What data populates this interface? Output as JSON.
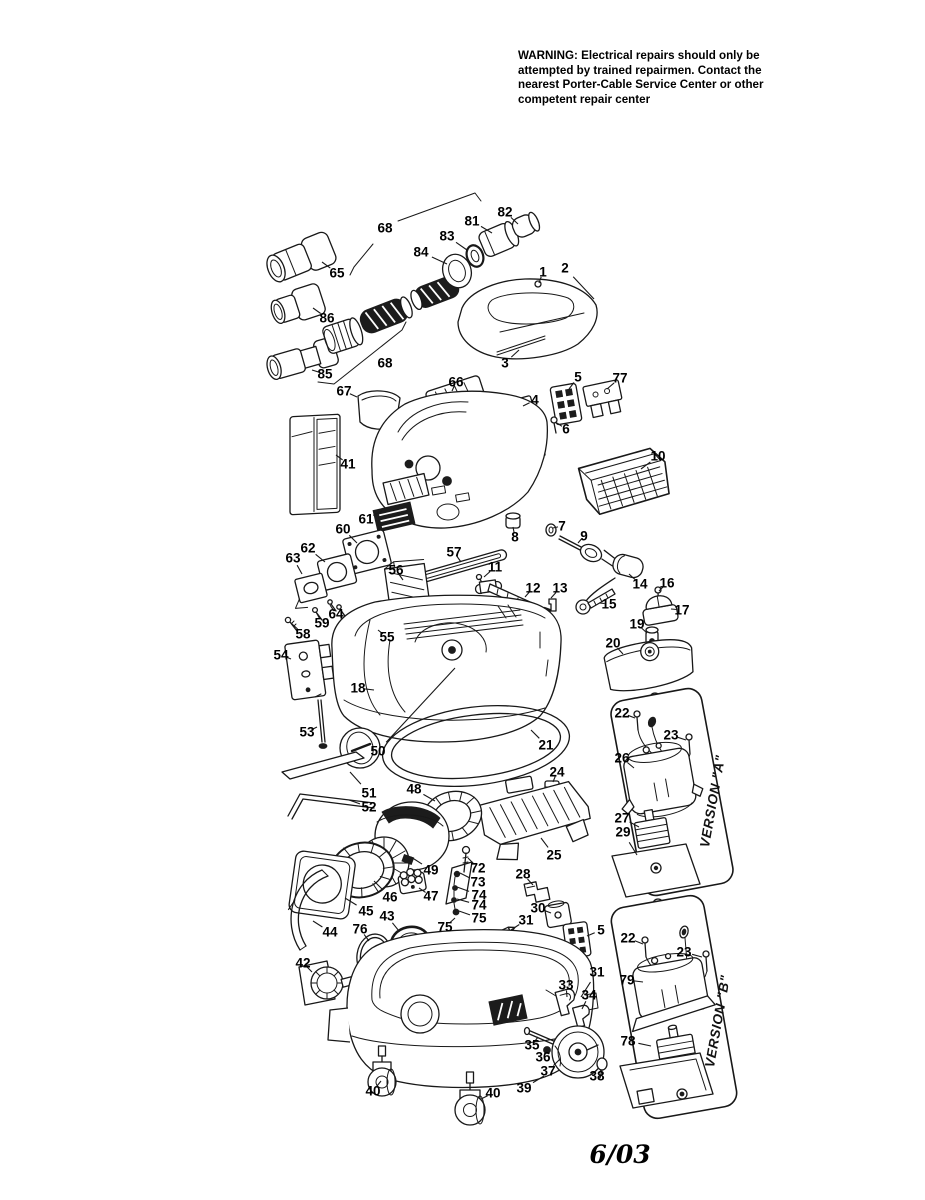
{
  "warning": {
    "lines": [
      "WARNING: Electrical repairs should only be",
      "attempted by trained repairmen. Contact the",
      "nearest Porter-Cable Service Center or other",
      "competent  repair center"
    ]
  },
  "footer": {
    "revision_date": "6/03"
  },
  "diagram": {
    "version_a_label": "VERSION \"A\"",
    "version_b_label": "VERSION \"B\"",
    "labels": [
      {
        "t": "68",
        "x": 385,
        "y": 228
      },
      {
        "t": "82",
        "x": 505,
        "y": 212,
        "lx": 518,
        "ly": 224
      },
      {
        "t": "81",
        "x": 472,
        "y": 221,
        "lx": 492,
        "ly": 233
      },
      {
        "t": "83",
        "x": 447,
        "y": 236,
        "lx": 467,
        "ly": 250
      },
      {
        "t": "84",
        "x": 421,
        "y": 252,
        "lx": 447,
        "ly": 264
      },
      {
        "t": "65",
        "x": 337,
        "y": 273,
        "lx": 322,
        "ly": 262
      },
      {
        "t": "1",
        "x": 543,
        "y": 272,
        "lx": 539,
        "ly": 283
      },
      {
        "t": "2",
        "x": 565,
        "y": 268,
        "lx": 594,
        "ly": 299
      },
      {
        "t": "86",
        "x": 327,
        "y": 318,
        "lx": 313,
        "ly": 308
      },
      {
        "t": "85",
        "x": 325,
        "y": 374,
        "lx": 312,
        "ly": 370
      },
      {
        "t": "68",
        "x": 385,
        "y": 363
      },
      {
        "t": "3",
        "x": 505,
        "y": 363,
        "lx": 519,
        "ly": 350
      },
      {
        "t": "67",
        "x": 344,
        "y": 391,
        "lx": 357,
        "ly": 397
      },
      {
        "t": "66",
        "x": 456,
        "y": 382,
        "lx": 452,
        "ly": 391
      },
      {
        "t": "5",
        "x": 578,
        "y": 377,
        "lx": 569,
        "ly": 389
      },
      {
        "t": "77",
        "x": 620,
        "y": 378,
        "lx": 607,
        "ly": 389
      },
      {
        "t": "4",
        "x": 535,
        "y": 400,
        "lx": 523,
        "ly": 406
      },
      {
        "t": "6",
        "x": 566,
        "y": 429,
        "lx": 557,
        "ly": 423
      },
      {
        "t": "41",
        "x": 348,
        "y": 464,
        "lx": 336,
        "ly": 455
      },
      {
        "t": "10",
        "x": 658,
        "y": 456,
        "lx": 641,
        "ly": 469
      },
      {
        "t": "61",
        "x": 366,
        "y": 519,
        "lx": 382,
        "ly": 511
      },
      {
        "t": "60",
        "x": 343,
        "y": 529,
        "lx": 357,
        "ly": 543
      },
      {
        "t": "62",
        "x": 308,
        "y": 548,
        "lx": 325,
        "ly": 562
      },
      {
        "t": "63",
        "x": 293,
        "y": 558,
        "lx": 302,
        "ly": 574
      },
      {
        "t": "8",
        "x": 515,
        "y": 537,
        "lx": 513,
        "ly": 527
      },
      {
        "t": "7",
        "x": 562,
        "y": 526,
        "lx": 553,
        "ly": 528
      },
      {
        "t": "9",
        "x": 584,
        "y": 536,
        "lx": 578,
        "ly": 543
      },
      {
        "t": "57",
        "x": 454,
        "y": 552,
        "lx": 461,
        "ly": 562
      },
      {
        "t": "56",
        "x": 396,
        "y": 570,
        "lx": 403,
        "ly": 580
      },
      {
        "t": "11",
        "x": 495,
        "y": 567,
        "lx": 484,
        "ly": 577
      },
      {
        "t": "12",
        "x": 533,
        "y": 588,
        "lx": 525,
        "ly": 597
      },
      {
        "t": "13",
        "x": 560,
        "y": 588,
        "lx": 551,
        "ly": 598
      },
      {
        "t": "14",
        "x": 640,
        "y": 584,
        "lx": 629,
        "ly": 574
      },
      {
        "t": "16",
        "x": 667,
        "y": 583,
        "lx": 659,
        "ly": 591
      },
      {
        "t": "15",
        "x": 609,
        "y": 604,
        "lx": 599,
        "ly": 603
      },
      {
        "t": "17",
        "x": 682,
        "y": 610,
        "lx": 671,
        "ly": 609
      },
      {
        "t": "64",
        "x": 336,
        "y": 614,
        "lx": 330,
        "ly": 605
      },
      {
        "t": "59",
        "x": 322,
        "y": 623,
        "lx": 316,
        "ly": 612
      },
      {
        "t": "58",
        "x": 303,
        "y": 634,
        "lx": 291,
        "ly": 623
      },
      {
        "t": "55",
        "x": 387,
        "y": 637,
        "lx": 378,
        "ly": 630
      },
      {
        "t": "19",
        "x": 637,
        "y": 624,
        "lx": 647,
        "ly": 633
      },
      {
        "t": "54",
        "x": 281,
        "y": 655,
        "lx": 291,
        "ly": 659
      },
      {
        "t": "20",
        "x": 613,
        "y": 643,
        "lx": 623,
        "ly": 654
      },
      {
        "t": "18",
        "x": 358,
        "y": 688,
        "lx": 374,
        "ly": 690
      },
      {
        "t": "53",
        "x": 307,
        "y": 732,
        "lx": 317,
        "ly": 727
      },
      {
        "t": "50",
        "x": 378,
        "y": 751,
        "lx": 455,
        "ly": 668
      },
      {
        "t": "21",
        "x": 546,
        "y": 745,
        "lx": 531,
        "ly": 730
      },
      {
        "t": "22",
        "x": 622,
        "y": 713,
        "lx": 635,
        "ly": 718
      },
      {
        "t": "23",
        "x": 671,
        "y": 735,
        "lx": 686,
        "ly": 740
      },
      {
        "t": "26",
        "x": 622,
        "y": 758,
        "lx": 634,
        "ly": 768
      },
      {
        "t": "24",
        "x": 557,
        "y": 772,
        "lx": 553,
        "ly": 782
      },
      {
        "t": "51",
        "x": 369,
        "y": 793,
        "lx": 350,
        "ly": 772
      },
      {
        "t": "52",
        "x": 369,
        "y": 807,
        "lx": 349,
        "ly": 800
      },
      {
        "t": "48",
        "x": 414,
        "y": 789,
        "lx": 435,
        "ly": 801
      },
      {
        "t": "27",
        "x": 622,
        "y": 818,
        "lx": 639,
        "ly": 827
      },
      {
        "t": "29",
        "x": 623,
        "y": 832,
        "lx": 637,
        "ly": 855
      },
      {
        "t": "25",
        "x": 554,
        "y": 855,
        "lx": 541,
        "ly": 838
      },
      {
        "t": "49",
        "x": 431,
        "y": 870,
        "lx": 411,
        "ly": 857
      },
      {
        "t": "72",
        "x": 478,
        "y": 868,
        "lx": 468,
        "ly": 858
      },
      {
        "t": "73",
        "x": 478,
        "y": 882,
        "lx": 460,
        "ly": 873
      },
      {
        "t": "74",
        "x": 479,
        "y": 895,
        "lx": 457,
        "ly": 887
      },
      {
        "t": "74",
        "x": 479,
        "y": 905,
        "lx": 457,
        "ly": 899
      },
      {
        "t": "75",
        "x": 479,
        "y": 918,
        "lx": 459,
        "ly": 911
      },
      {
        "t": "28",
        "x": 523,
        "y": 874,
        "lx": 533,
        "ly": 885
      },
      {
        "t": "47",
        "x": 431,
        "y": 896,
        "lx": 419,
        "ly": 888
      },
      {
        "t": "46",
        "x": 390,
        "y": 897,
        "lx": 374,
        "ly": 881
      },
      {
        "t": "30",
        "x": 538,
        "y": 908,
        "lx": 551,
        "ly": 913
      },
      {
        "t": "31",
        "x": 526,
        "y": 920,
        "lx": 511,
        "ly": 930
      },
      {
        "t": "45",
        "x": 366,
        "y": 911,
        "lx": 345,
        "ly": 898
      },
      {
        "t": "43",
        "x": 387,
        "y": 916,
        "lx": 399,
        "ly": 931
      },
      {
        "t": "76",
        "x": 360,
        "y": 929,
        "lx": 369,
        "ly": 941
      },
      {
        "t": "44",
        "x": 330,
        "y": 932,
        "lx": 313,
        "ly": 921
      },
      {
        "t": "75",
        "x": 445,
        "y": 927,
        "lx": 455,
        "ly": 918
      },
      {
        "t": "5",
        "x": 601,
        "y": 930,
        "lx": 587,
        "ly": 936
      },
      {
        "t": "22",
        "x": 628,
        "y": 938,
        "lx": 643,
        "ly": 944
      },
      {
        "t": "23",
        "x": 684,
        "y": 952,
        "lx": 702,
        "ly": 957
      },
      {
        "t": "79",
        "x": 627,
        "y": 980,
        "lx": 643,
        "ly": 982
      },
      {
        "t": "42",
        "x": 303,
        "y": 963,
        "lx": 312,
        "ly": 972
      },
      {
        "t": "31",
        "x": 597,
        "y": 972,
        "lx": 581,
        "ly": 997
      },
      {
        "t": "33",
        "x": 566,
        "y": 985,
        "lx": 567,
        "ly": 997
      },
      {
        "t": "34",
        "x": 589,
        "y": 995,
        "lx": 582,
        "ly": 1009
      },
      {
        "t": "78",
        "x": 628,
        "y": 1041,
        "lx": 651,
        "ly": 1046
      },
      {
        "t": "35",
        "x": 532,
        "y": 1045,
        "lx": 538,
        "ly": 1037
      },
      {
        "t": "36",
        "x": 543,
        "y": 1057,
        "lx": 546,
        "ly": 1051
      },
      {
        "t": "37",
        "x": 548,
        "y": 1071,
        "lx": 560,
        "ly": 1059
      },
      {
        "t": "38",
        "x": 597,
        "y": 1076,
        "lx": 601,
        "ly": 1070
      },
      {
        "t": "39",
        "x": 524,
        "y": 1088,
        "lx": 544,
        "ly": 1076
      },
      {
        "t": "40",
        "x": 373,
        "y": 1091,
        "lx": 381,
        "ly": 1081
      },
      {
        "t": "40",
        "x": 493,
        "y": 1093,
        "lx": 481,
        "ly": 1099
      }
    ]
  }
}
